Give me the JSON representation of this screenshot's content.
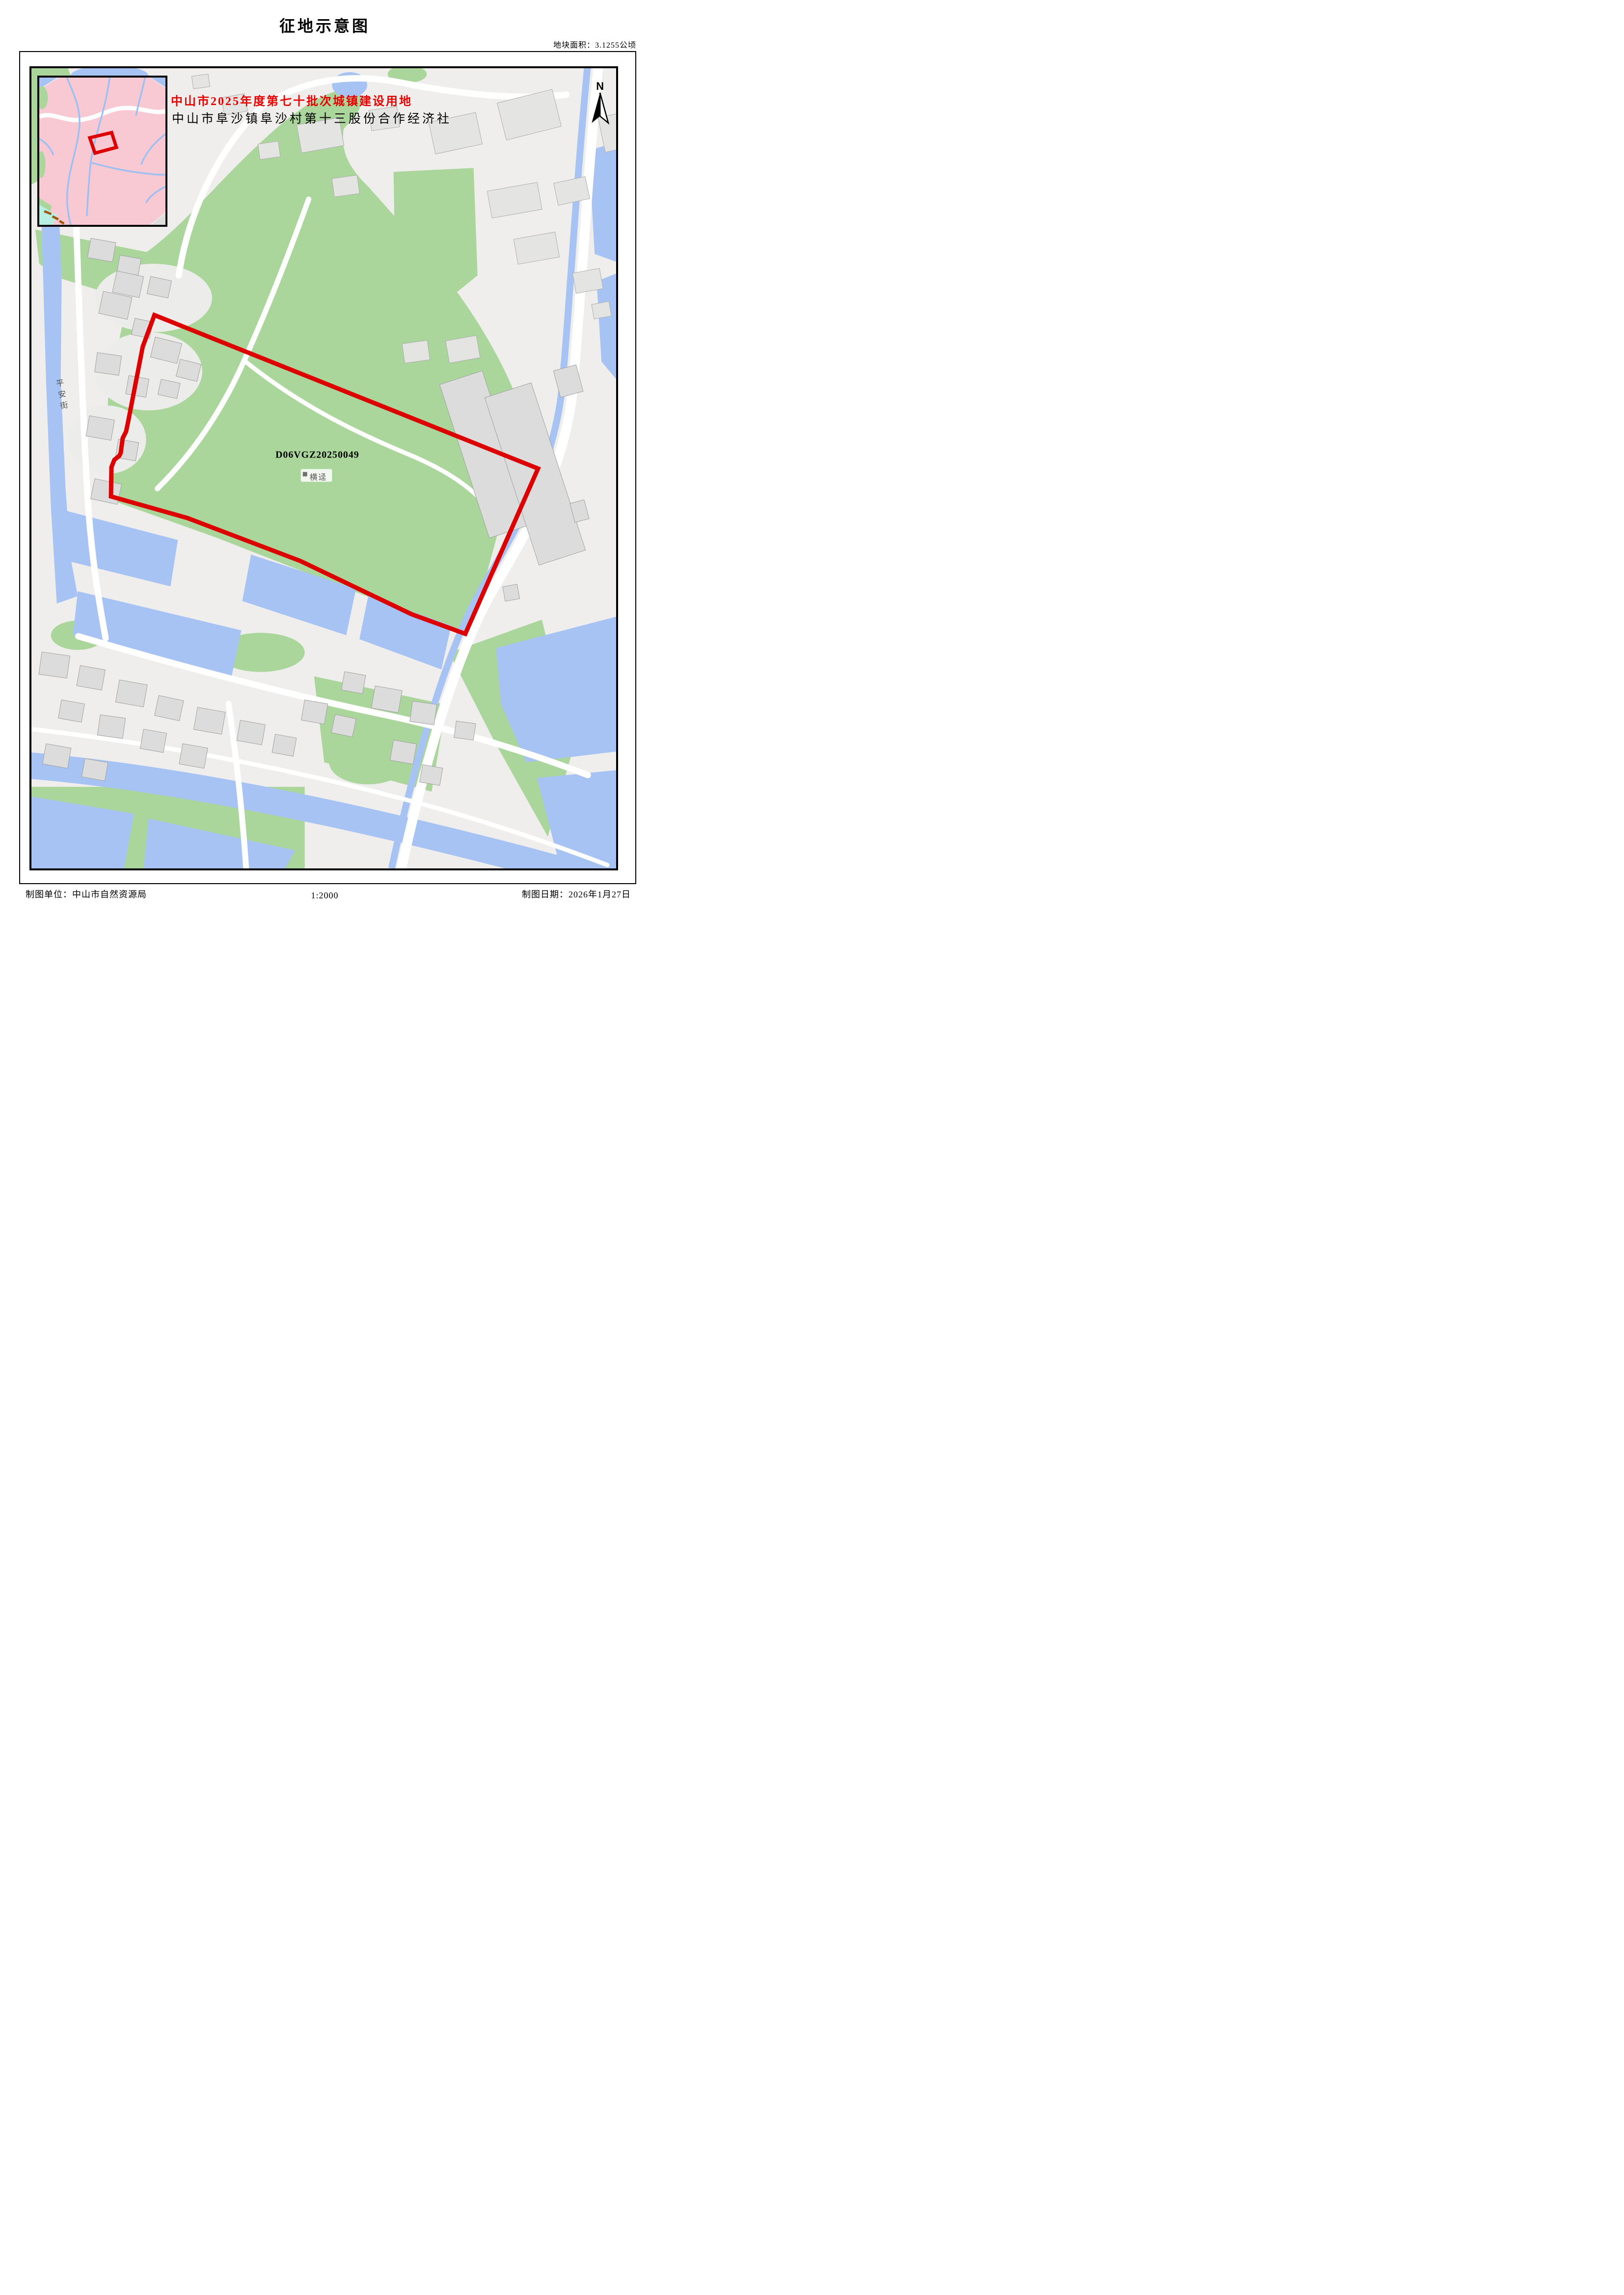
{
  "header": {
    "title": "征地示意图",
    "area_label": "地块面积：3.1255公顷"
  },
  "map": {
    "red_heading": "中山市2025年度第七十批次城镇建设用地",
    "black_heading": "中山市阜沙镇阜沙村第十三股份合作经济社",
    "parcel_code": "D06VGZ20250049",
    "place_label": "横迳",
    "street_label": "平安街",
    "north_label": "N",
    "scale_ratio": "1:2000"
  },
  "footer": {
    "unit": "制图单位：中山市自然资源局",
    "scale": "1:2000",
    "date": "制图日期：2026年1月27日"
  },
  "colors": {
    "boundary_red": "#dd0000",
    "heading_red": "#e60000",
    "green_area": "#abd69b",
    "water_blue": "#a6c3f4",
    "inset_pink": "#f8c9d2",
    "inset_cyan": "#b7f0e2",
    "inset_stream_blue": "#9cc0f2",
    "building_fill": "#dcdcdc",
    "building_stroke": "#a0a0a0",
    "road_white": "#ffffff",
    "map_bg": "#efeeec",
    "frame_black": "#000000"
  }
}
